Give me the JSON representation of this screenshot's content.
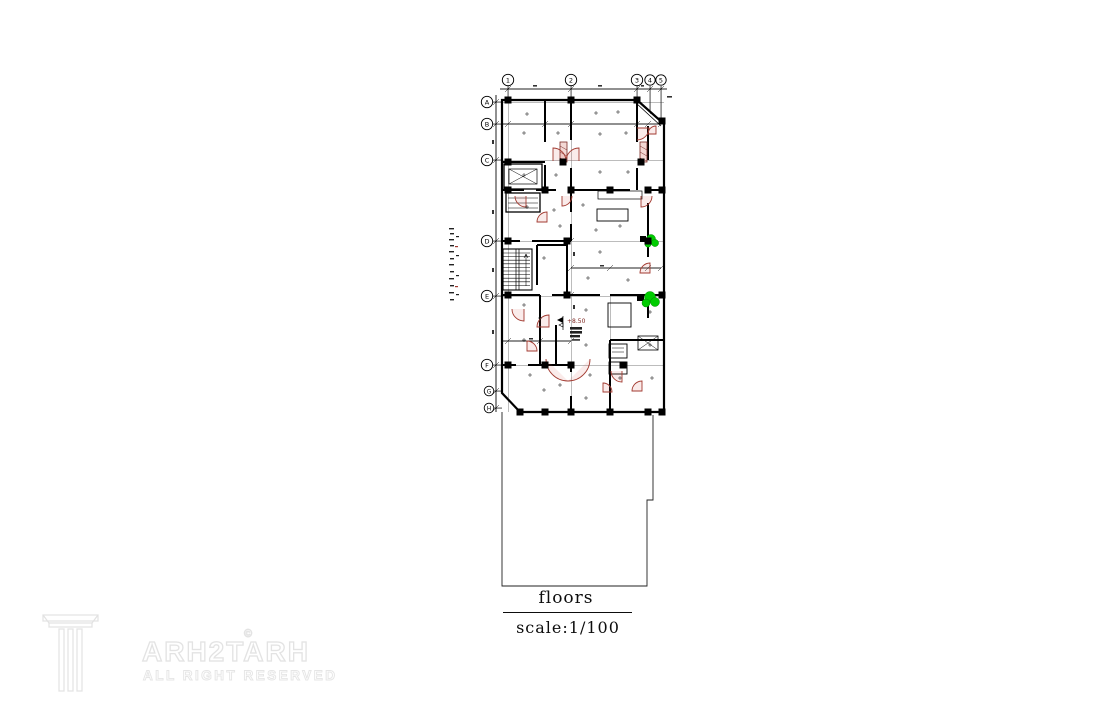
{
  "drawing": {
    "title": "floors",
    "scale_label": "scale:1/100",
    "level_marker": "+8.50",
    "grid": {
      "top_labels": [
        "1",
        "2",
        "3",
        "4",
        "5"
      ],
      "left_labels": [
        "A",
        "B",
        "C",
        "D",
        "E",
        "F",
        "G",
        "H"
      ]
    },
    "colors": {
      "line": "#000000",
      "door_swing": "#a23a30",
      "plant": "#00cc00"
    }
  },
  "watermark": {
    "brand": "ARH2TARH",
    "copyright": "©",
    "tagline": "ALL RIGHT RESERVED",
    "logo": "column-pillar-icon"
  }
}
